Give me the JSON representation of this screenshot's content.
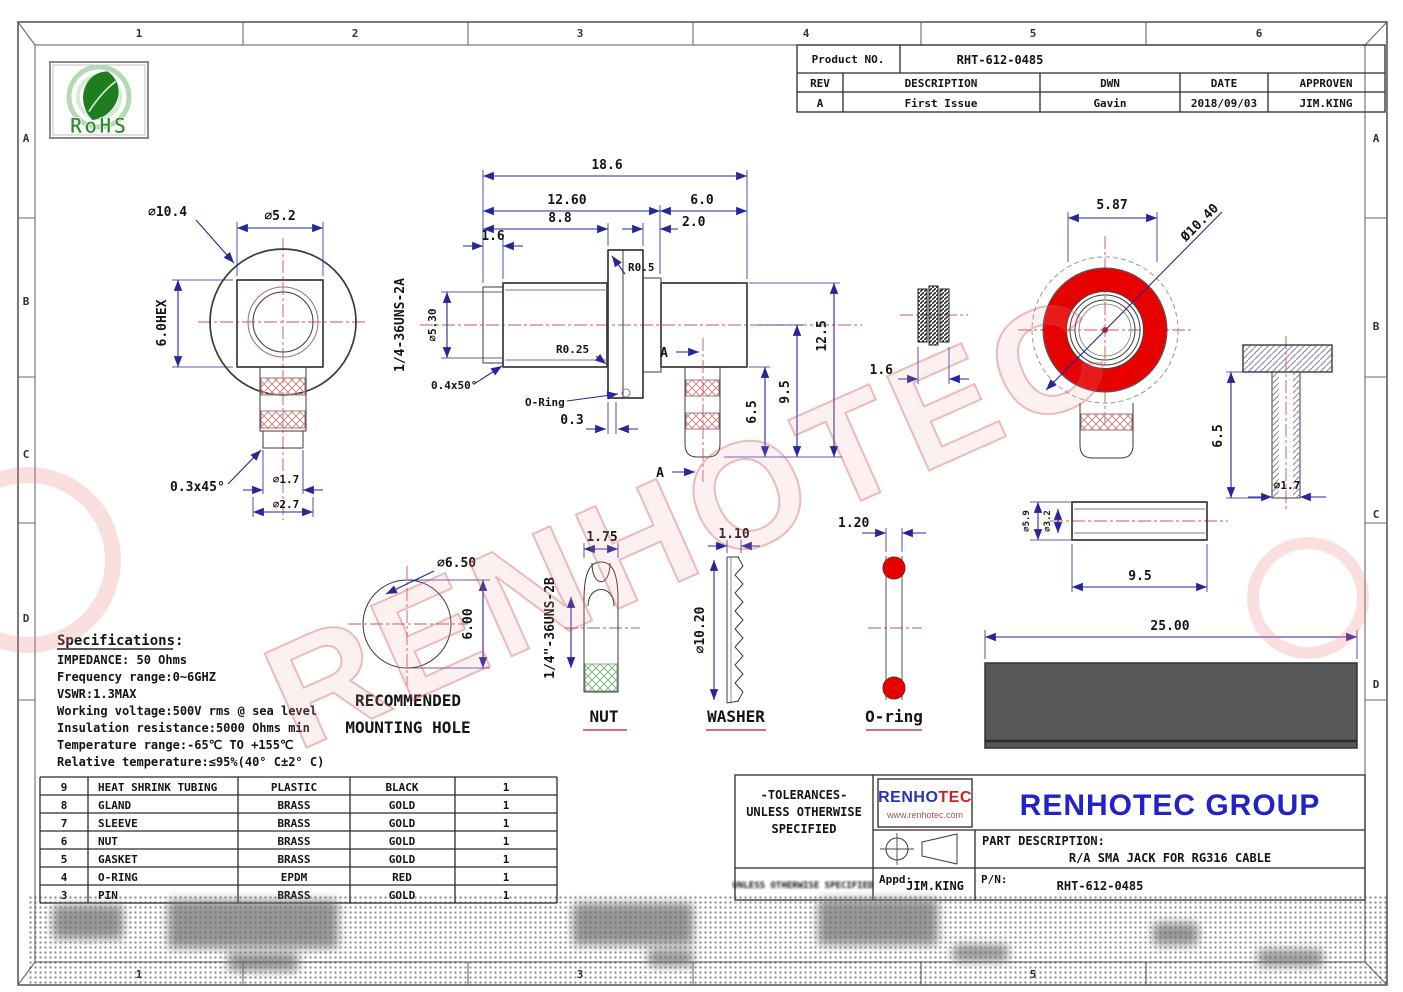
{
  "zones": {
    "top": [
      "1",
      "2",
      "3",
      "4",
      "5",
      "6"
    ],
    "side": [
      "A",
      "B",
      "C",
      "D"
    ]
  },
  "rohs_label": "RoHS",
  "watermark": "RENHOTEC",
  "revision": {
    "product_label": "Product NO.",
    "product_value": "RHT-612-0485",
    "headers": [
      "REV",
      "DESCRIPTION",
      "DWN",
      "DATE",
      "APPROVEN"
    ],
    "row": [
      "A",
      "First Issue",
      "Gavin",
      "2018/09/03",
      "JIM.KING"
    ]
  },
  "specs": {
    "title": "Specifications:",
    "lines": [
      "IMPEDANCE: 50 Ohms",
      "Frequency range:0~6GHZ",
      "VSWR:1.3MAX",
      "Working voltage:500V rms @ sea level",
      "Insulation resistance:5000 Ohms min",
      "Temperature range:-65℃ TO +155℃",
      "Relative temperature:≤95%(40° C±2° C)"
    ]
  },
  "parts": {
    "rows": [
      [
        "9",
        "HEAT SHRINK TUBING",
        "PLASTIC",
        "BLACK",
        "1"
      ],
      [
        "8",
        "GLAND",
        "BRASS",
        "GOLD",
        "1"
      ],
      [
        "7",
        "SLEEVE",
        "BRASS",
        "GOLD",
        "1"
      ],
      [
        "6",
        "NUT",
        "BRASS",
        "GOLD",
        "1"
      ],
      [
        "5",
        "GASKET",
        "BRASS",
        "GOLD",
        "1"
      ],
      [
        "4",
        "O-RING",
        "EPDM",
        "RED",
        "1"
      ],
      [
        "3",
        "PIN",
        "BRASS",
        "GOLD",
        "1"
      ]
    ]
  },
  "title_block": {
    "tolerances": [
      "-TOLERANCES-",
      "UNLESS OTHERWISE",
      "SPECIFIED"
    ],
    "logo_left": "RENHO",
    "logo_right": "TEC",
    "logo_url": "www.renhotec.com",
    "company": "RENHOTEC GROUP",
    "part_desc_label": "PART DESCRIPTION:",
    "part_desc": "R/A SMA JACK FOR RG316 CABLE",
    "appd_label": "Appd:",
    "appd_value": "JIM.KING",
    "pn_label": "P/N:",
    "pn_value": "RHT-612-0485",
    "blurred_note": "UNLESS OTHERWISE SPECIFIED"
  },
  "views": {
    "flange": {
      "dia_outer": "⌀10.4",
      "dia_across": "⌀5.2",
      "hex": "6.0HEX",
      "chamfer": "0.3x45°",
      "dia_pin": "⌀1.7",
      "dia_tip": "⌀2.7"
    },
    "main": {
      "len_total": "18.6",
      "len_body": "12.60",
      "len_right": "6.0",
      "len_a": "8.8",
      "len_b": "2.0",
      "len_c": "1.6",
      "thread": "1/4-36UNS-2A",
      "dia_thread": "⌀5.30",
      "rad_a": "R0.5",
      "rad_b": "R0.25",
      "chamfer": "0.4x50°",
      "oring": "O-Ring",
      "plate": "0.3",
      "h_a": "6.5",
      "h_b": "9.5",
      "h_c": "12.5",
      "section": "A"
    },
    "gasket": {
      "w": "1.6"
    },
    "front": {
      "w": "5.87",
      "dia": "Ø10.40"
    },
    "pin": {
      "h": "6.5",
      "dia": "⌀1.7"
    },
    "sleeve": {
      "dia_outer": "⌀5.9",
      "dia_inner": "⌀3.2",
      "len": "9.5"
    },
    "tubing": {
      "len": "25.00"
    },
    "hole": {
      "dia": "⌀6.50",
      "h": "6.00",
      "caption1": "RECOMMENDED",
      "caption2": "MOUNTING HOLE"
    },
    "nut": {
      "w": "1.75",
      "thread": "1/4\"-36UNS-2B",
      "caption": "NUT"
    },
    "washer": {
      "w": "1.10",
      "dia": "⌀10.20",
      "caption": "WASHER"
    },
    "oring": {
      "w": "1.20",
      "caption": "O-ring"
    }
  },
  "colors": {
    "accent_red": "#e60000",
    "brand_blue": "#2222cc",
    "logo_red": "#cc2222",
    "dim_blue": "#26269a",
    "centerline_red": "#cc5555",
    "rohs_green": "#2e8b2e"
  }
}
